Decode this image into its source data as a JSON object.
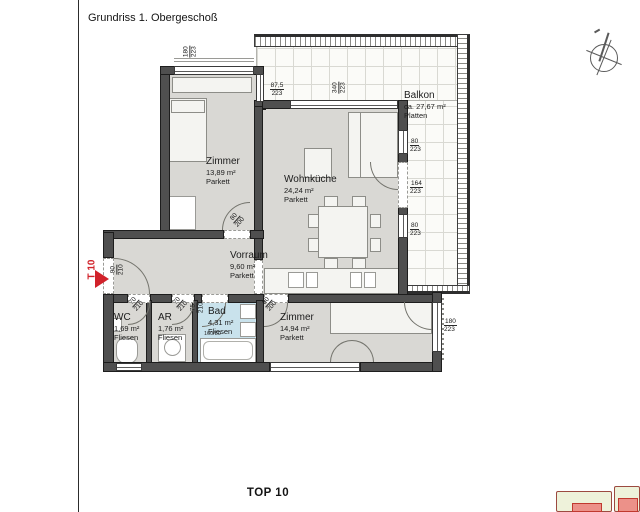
{
  "title": "Grundriss 1. Obergeschoß",
  "unit_label": "TOP 10",
  "door_tag": "T 10",
  "rooms": {
    "zimmer1": {
      "name": "Zimmer",
      "area": "13,89 m²",
      "floor": "Parkett"
    },
    "wohnkueche": {
      "name": "Wohnküche",
      "area": "24,24 m²",
      "floor": "Parkett"
    },
    "balkon": {
      "name": "Balkon",
      "area": "ca. 27,67 m²",
      "floor": "Platten"
    },
    "vorraum": {
      "name": "Vorraum",
      "area": "9,60 m²",
      "floor": "Parkett"
    },
    "wc": {
      "name": "WC",
      "area": "1,69 m²",
      "floor": "Fliesen"
    },
    "ar": {
      "name": "AR",
      "area": "1,76 m²",
      "floor": "Fliesen"
    },
    "bad": {
      "name": "Bad",
      "area": "4,31 m²",
      "floor": "Fliesen"
    },
    "zimmer2": {
      "name": "Zimmer",
      "area": "14,94 m²",
      "floor": "Parkett"
    }
  },
  "dimensions": {
    "win_zimmer1": {
      "top": "180",
      "bottom": "223"
    },
    "win_step": {
      "top": "87,5",
      "bottom": "223"
    },
    "win_wohnkueche": {
      "top": "340",
      "bottom": "223"
    },
    "win_balkon_1": {
      "top": "80",
      "bottom": "223"
    },
    "door_balkon": {
      "top": "164",
      "bottom": "223"
    },
    "win_balkon_2": {
      "top": "80",
      "bottom": "223"
    },
    "win_zimmer2": {
      "top": "180",
      "bottom": "223"
    },
    "door_entrance": {
      "top": "90",
      "bottom": "210"
    },
    "door_zimmer1": {
      "top": "80",
      "bottom": "200"
    },
    "door_wc": {
      "top": "70",
      "bottom": "210"
    },
    "door_ar": {
      "top": "70",
      "bottom": "210"
    },
    "door_bad": {
      "top": "75",
      "bottom": "210"
    },
    "door_zimmer2": {
      "top": "80",
      "bottom": "200"
    },
    "bathtub": "160/80"
  },
  "colors": {
    "accent_red": "#d1222a",
    "wall": "#4f4f4f",
    "room_floor": "#d9d8d4",
    "bad_floor": "#c9e2ec",
    "keyplan_green": "#eef2da",
    "keyplan_salmon": "#ec9189"
  }
}
